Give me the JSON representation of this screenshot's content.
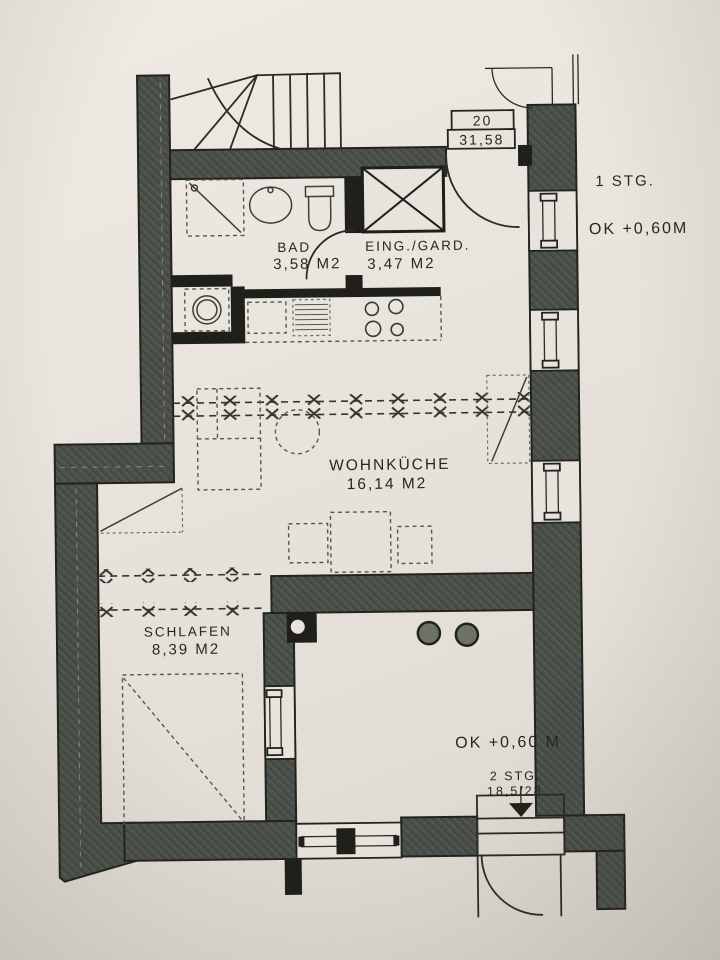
{
  "photo": {
    "paper_color": "#e8e4dd",
    "ink_color": "#23231e",
    "wall_color": "#4b504b"
  },
  "plan": {
    "apartment_box": {
      "number": "20",
      "area": "31,58"
    },
    "annotations": {
      "stairs_up": "1 STG.",
      "level_upper": "OK +0,60M",
      "level_lower": "OK +0,60 M",
      "stairs_down_count": "2 STG.",
      "stairs_down_dim": "18,5/28"
    },
    "rooms": [
      {
        "name": "BAD",
        "area": "3,58 M2"
      },
      {
        "name": "EING./GARD.",
        "area": "3,47 M2"
      },
      {
        "name": "WOHNKÜCHE",
        "area": "16,14 M2"
      },
      {
        "name": "SCHLAFEN",
        "area": "8,39 M2"
      }
    ]
  }
}
